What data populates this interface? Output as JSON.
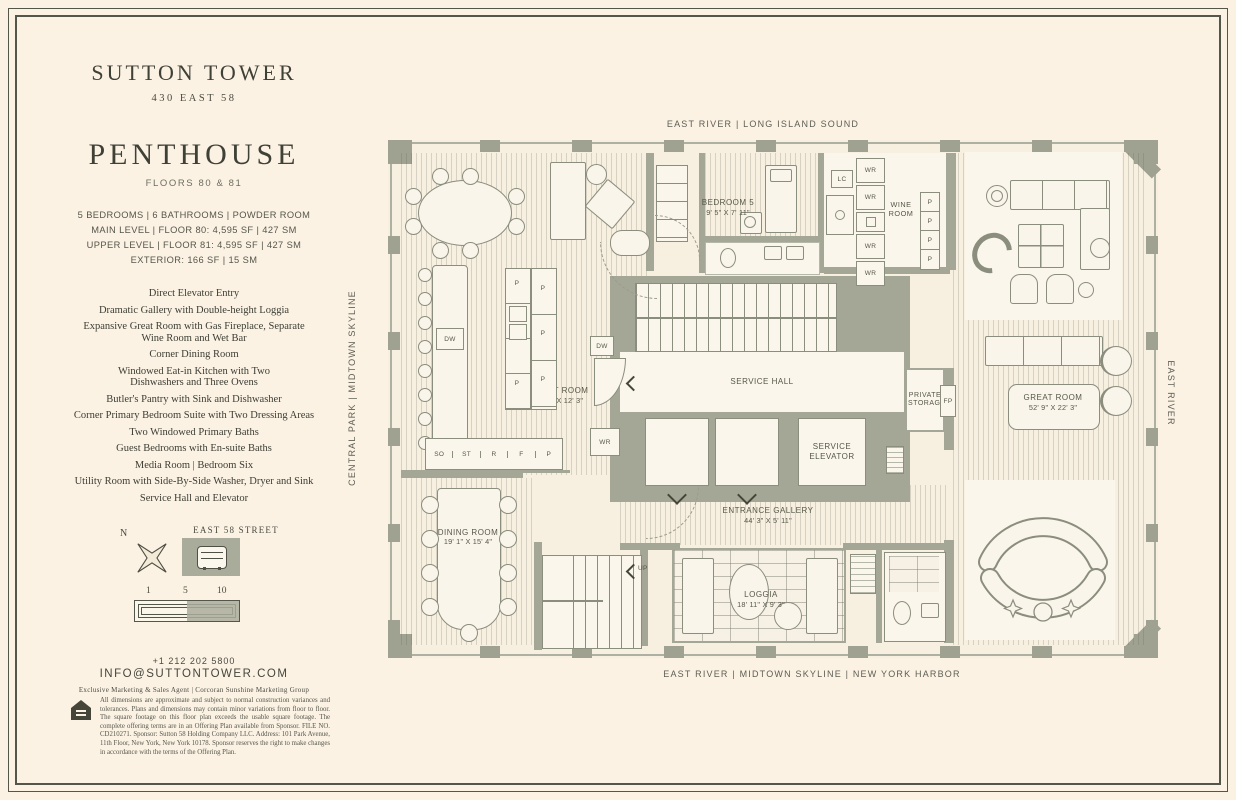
{
  "brand": {
    "name": "SUTTON TOWER",
    "address": "430 EAST 58"
  },
  "listing": {
    "title": "PENTHOUSE",
    "floors": "FLOORS 80 & 81",
    "stats": [
      "5 BEDROOMS | 6 BATHROOMS | POWDER ROOM",
      "MAIN LEVEL | FLOOR 80: 4,595 SF | 427 SM",
      "UPPER LEVEL | FLOOR 81: 4,595 SF | 427 SM",
      "EXTERIOR: 166 SF | 15 SM"
    ],
    "features": [
      "Direct Elevator Entry",
      "Dramatic Gallery with Double-height Loggia",
      "Expansive Great Room with Gas Fireplace, Separate Wine Room and Wet Bar",
      "Corner Dining Room",
      "Windowed Eat-in Kitchen with Two Dishwashers and Three Ovens",
      "Butler's Pantry with Sink and Dishwasher",
      "Corner Primary Bedroom Suite with Two Dressing Areas",
      "Two Windowed Primary Baths",
      "Guest Bedrooms with En-suite Baths",
      "Media Room | Bedroom Six",
      "Utility Room with Side-By-Side Washer, Dryer and Sink",
      "Service Hall and Elevator"
    ]
  },
  "site": {
    "north": "N",
    "street": "EAST 58 STREET",
    "scale_ticks": [
      "1",
      "5",
      "10"
    ]
  },
  "contact": {
    "phone": "+1 212 202 5800",
    "email": "INFO@SUTTONTOWER.COM",
    "agent": "Exclusive Marketing & Sales Agent | Corcoran Sunshine Marketing Group"
  },
  "legal": {
    "disclaimer": "All dimensions are approximate and subject to normal construction variances and tolerances. Plans and dimensions may contain minor variations from floor to floor. The square footage on this floor plan exceeds the usable square footage. The complete offering terms are in an Offering Plan available from Sponsor. FILE NO. CD210271. Sponsor: Sutton 58 Holding Company LLC. Address: 101 Park Avenue, 11th Floor, New York, New York 10178. Sponsor reserves the right to make changes in accordance with the terms of the Offering Plan."
  },
  "plan": {
    "orientation": {
      "top": "EAST RIVER | LONG ISLAND SOUND",
      "bottom": "EAST RIVER | MIDTOWN SKYLINE | NEW YORK HARBOR",
      "left": "CENTRAL PARK | MIDTOWN SKYLINE",
      "right": "EAST RIVER"
    },
    "rooms": {
      "great_room_west": {
        "name": "GREAT ROOM",
        "dims": "38' 5\" X 12' 3\""
      },
      "bedroom5": {
        "name": "BEDROOM 5",
        "dims": "9' 5\" X 7' 11\""
      },
      "wine_room": {
        "name": "WINE ROOM"
      },
      "service_hall": {
        "name": "SERVICE HALL"
      },
      "private_storage": {
        "name": "PRIVATE STORAGE"
      },
      "service_elevator": {
        "name": "SERVICE ELEVATOR"
      },
      "great_room_east": {
        "name": "GREAT ROOM",
        "dims": "52' 9\" X 22' 3\""
      },
      "dining_room": {
        "name": "DINING ROOM",
        "dims": "19' 1\" X 15' 4\""
      },
      "entrance_gallery": {
        "name": "ENTRANCE GALLERY",
        "dims": "44' 3\" X 5' 11\""
      },
      "loggia": {
        "name": "LOGGIA",
        "dims": "18' 11\" X 9' 3\""
      }
    },
    "tags": {
      "dw": "DW",
      "wr": "WR",
      "lc": "LC",
      "fp": "FP",
      "up": "UP",
      "p": "P",
      "so": "SO",
      "st": "ST",
      "r": "R",
      "f": "F"
    }
  }
}
